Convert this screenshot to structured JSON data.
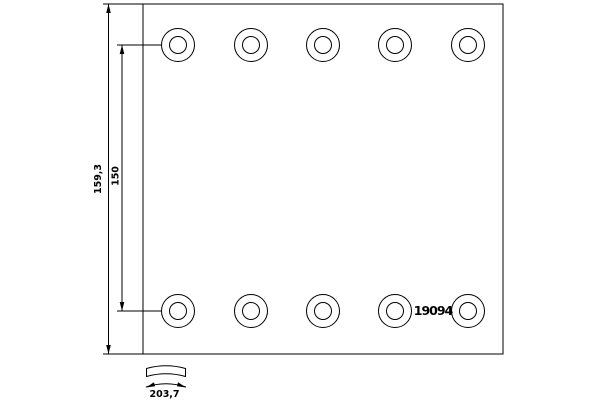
{
  "part": {
    "number": "19094"
  },
  "dimensions": {
    "overall_height": "159,3",
    "hole_pitch": "150",
    "arc_width": "203,7"
  },
  "holes": {
    "rows": 2,
    "per_row": 5
  },
  "colors": {
    "line": "#000000",
    "background": "#ffffff"
  }
}
